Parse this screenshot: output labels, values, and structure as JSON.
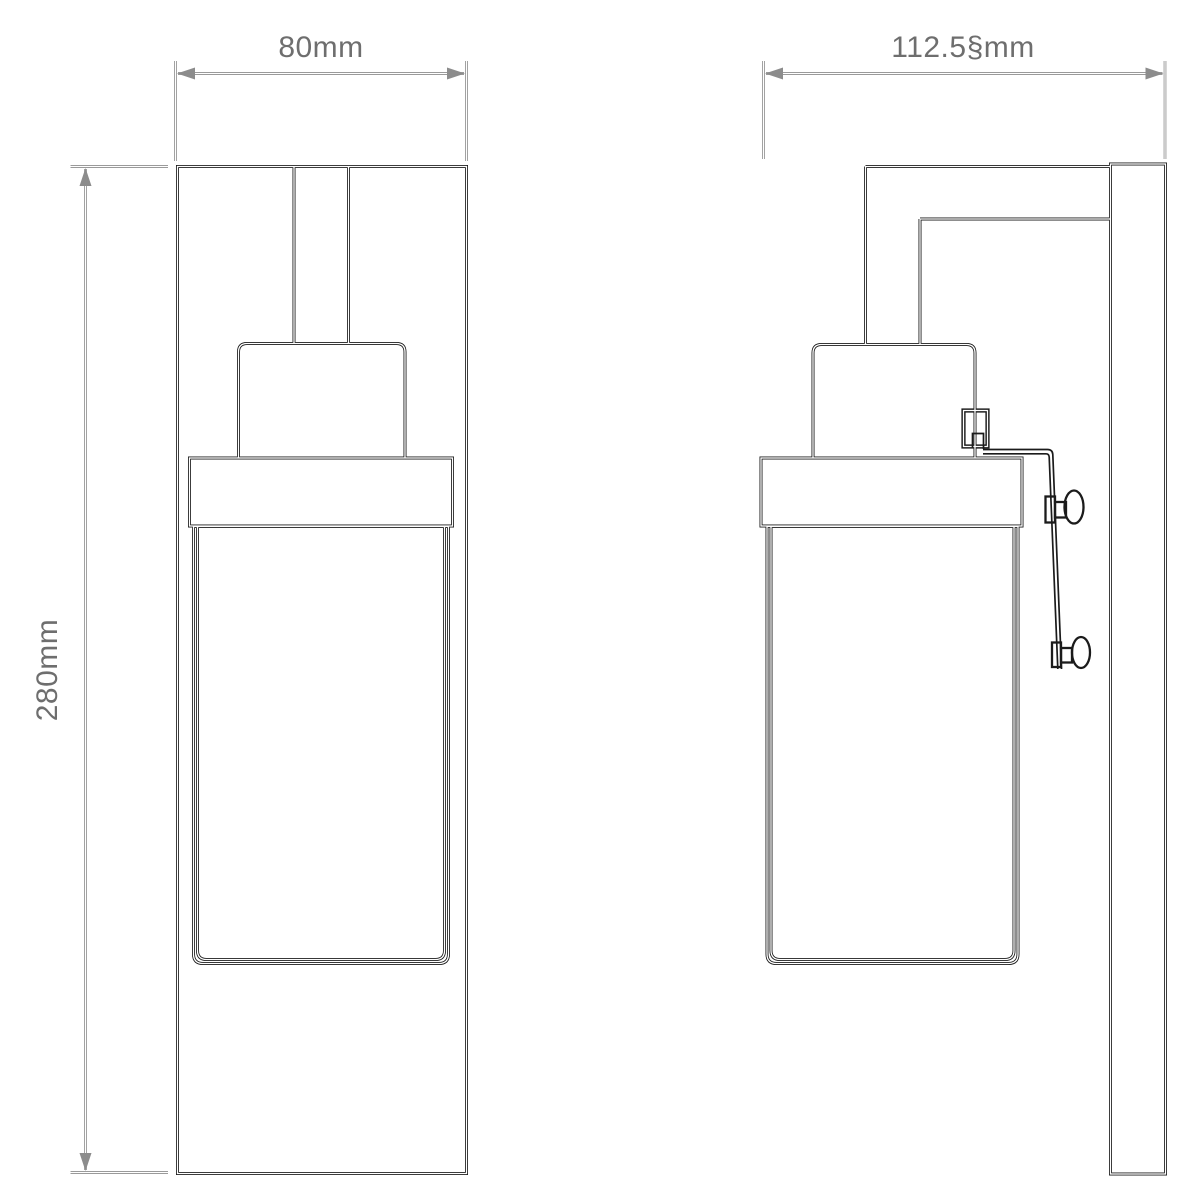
{
  "page": {
    "background_color": "#ffffff",
    "kind": "Technical dimension drawing",
    "subject": "Wall-mounted light fixture shown in front and side elevation"
  },
  "palette": {
    "drawing_line": "#1b1b1b",
    "dimension_line": "#8c8c8c",
    "label_text": "#6e6e6e"
  },
  "dimensions": {
    "width_label": "80mm",
    "depth_label": "112.5§mm",
    "height_label": "280mm"
  },
  "views": {
    "front_elevation": {
      "parts": [
        "backplate",
        "stem",
        "lamp holder",
        "gallery",
        "glass shade"
      ]
    },
    "side_elevation": {
      "parts": [
        "wall plate",
        "mounting arm",
        "lamp holder",
        "cable connector",
        "drop cable",
        "upper cord toggle",
        "lower cord toggle",
        "gallery",
        "glass shade"
      ]
    }
  }
}
